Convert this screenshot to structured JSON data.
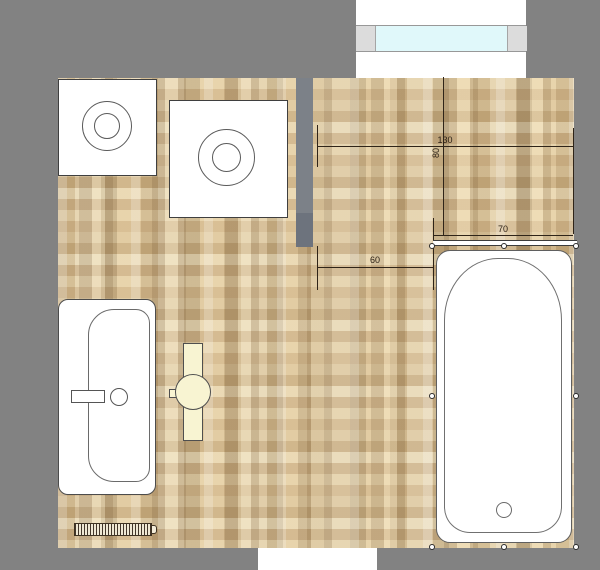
{
  "plan": {
    "type": "bathroom-floor-plan",
    "background_color": "#828282",
    "floor_color": "#d8c298",
    "wall_stub_color": "#767c86"
  },
  "dimensions": {
    "d130": {
      "label": "130"
    },
    "d80": {
      "label": "80"
    },
    "d70": {
      "label": "70"
    },
    "d60": {
      "label": "60"
    }
  },
  "fixtures": {
    "window": {
      "glass_color": "#e0f8fa",
      "frame_color": "#dcdcdc"
    },
    "appliance_left": {
      "symbol": "square-with-concentric-circles"
    },
    "appliance_right": {
      "symbol": "square-with-concentric-circles"
    },
    "bathtub": {
      "fill": "#ffffff",
      "selected": true,
      "handle_count": 8
    },
    "sink": {
      "fill": "#ffffff"
    },
    "toilet": {
      "fill": "#f8f4d2"
    },
    "radiator": {
      "fill": "#efe8d4"
    },
    "door_opening": {
      "fill": "#ffffff"
    }
  }
}
